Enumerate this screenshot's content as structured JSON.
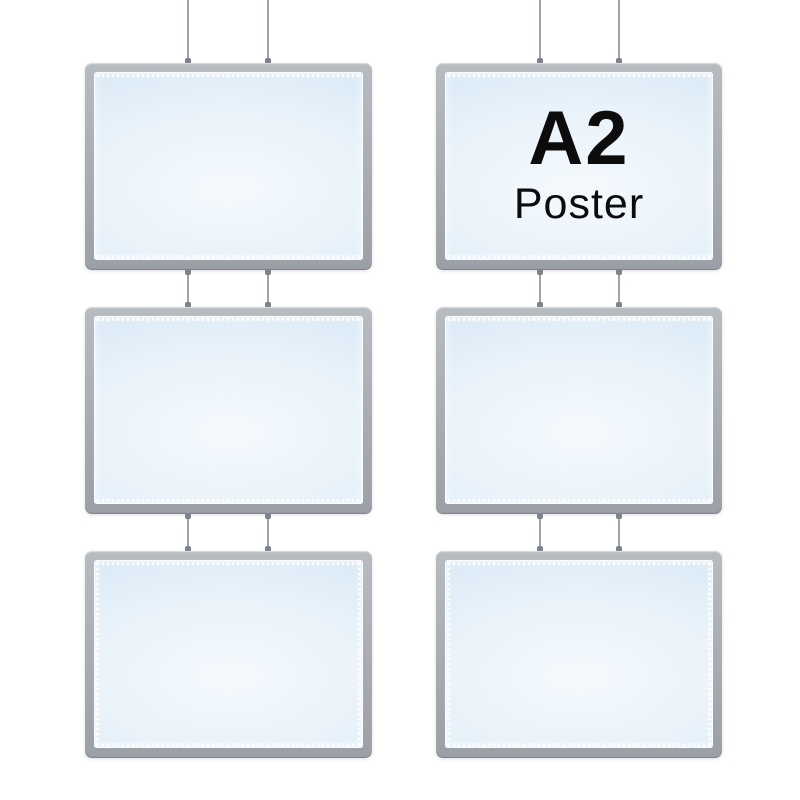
{
  "scene": {
    "title": "Six hanging LED light box poster frames, two columns of three, suspended on thin cables",
    "background_color": "#ffffff",
    "columns": 2,
    "rows": 3
  },
  "poster_label": {
    "size": "A2",
    "kind": "Poster"
  },
  "colors": {
    "frame_gray": "#aaafb5",
    "frame_gray_light": "#b7bcc1",
    "frame_gray_dark": "#9aa0a6",
    "panel_blue_edge": "#c7dcee",
    "panel_blue_center": "#f4f9fd",
    "led_dot_white": "#ffffff",
    "cable_gray": "#8d9398",
    "connector_gray": "#7e848a",
    "label_black": "#0c0c0c"
  },
  "frames": [
    {
      "position": "top-left",
      "label": ""
    },
    {
      "position": "top-right",
      "label": "A2 Poster"
    },
    {
      "position": "middle-left",
      "label": ""
    },
    {
      "position": "middle-right",
      "label": ""
    },
    {
      "position": "bottom-left",
      "label": ""
    },
    {
      "position": "bottom-right",
      "label": ""
    }
  ]
}
